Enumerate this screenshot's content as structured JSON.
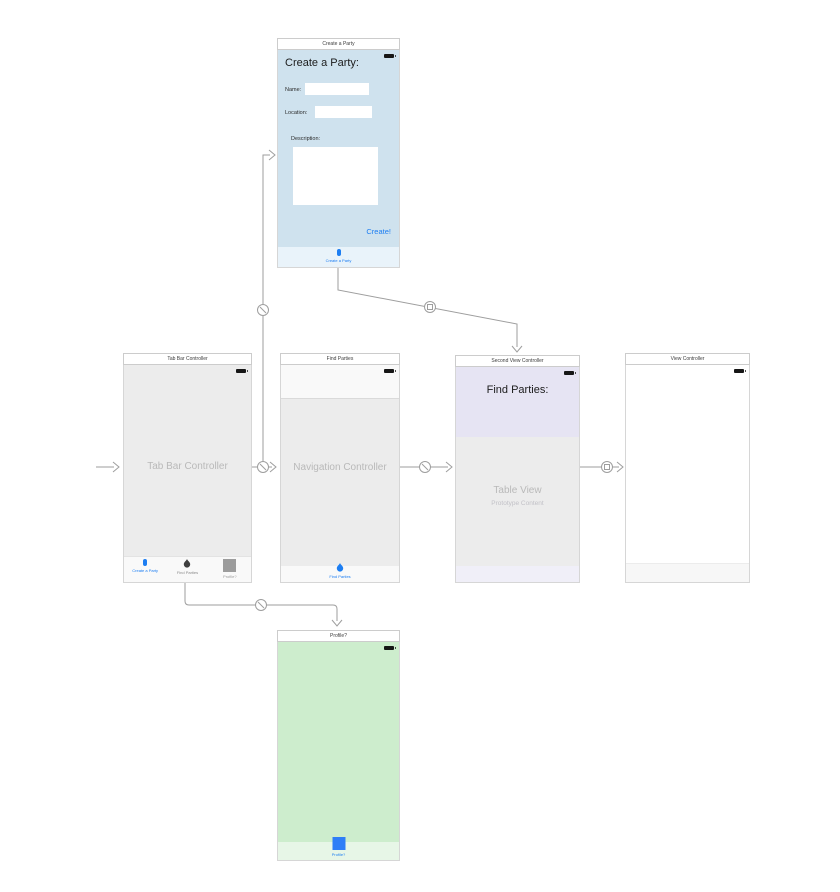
{
  "canvas": {
    "background": "#ffffff",
    "connector_color": "#9e9e9e"
  },
  "icons": {
    "battery-icon": "black rounded rectangle with nub",
    "create-party-tab-icon": "blue vertical pill",
    "find-parties-tab-icon": "flame",
    "profile-tab-icon": "gray filled square",
    "profile-scene-tab-icon": "blue filled square",
    "relationship-segue-icon": "circle with diagonal line",
    "show-segue-icon": "circle with small square"
  },
  "scenes": {
    "create_party": {
      "dock_title": "Create a Party",
      "heading": "Create a Party:",
      "name_label": "Name:",
      "name_value": "",
      "location_label": "Location:",
      "location_value": "",
      "description_label": "Description:",
      "description_value": "",
      "create_button": "Create!",
      "tab_label": "Create a Party",
      "colors": {
        "body": "#cfe2ee",
        "tab_strip": "#e9f3fa",
        "accent": "#1d7ef2"
      }
    },
    "tab_bar_controller": {
      "dock_title": "Tab Bar Controller",
      "placeholder_label": "Tab Bar Controller",
      "tabs": [
        {
          "label": "Create a Party",
          "icon": "create-party-tab-icon",
          "selected": true
        },
        {
          "label": "Find Parties",
          "icon": "find-parties-tab-icon",
          "selected": false
        },
        {
          "label": "Profile?",
          "icon": "profile-tab-icon",
          "selected": false
        }
      ],
      "colors": {
        "body": "#ececec"
      }
    },
    "navigation_controller": {
      "dock_title": "Find Parties",
      "placeholder_label": "Navigation Controller",
      "tab_label": "Find Parties",
      "colors": {
        "body": "#ececec",
        "bars": "#f9f9f9"
      }
    },
    "second_view_controller": {
      "dock_title": "Second View Controller",
      "heading": "Find Parties:",
      "table_label": "Table View",
      "table_sublabel": "Prototype Content",
      "colors": {
        "header": "#e6e4f3",
        "body": "#ececec",
        "footer": "#f0eff8"
      }
    },
    "view_controller": {
      "dock_title": "View Controller",
      "colors": {
        "body": "#ffffff",
        "footer": "#f7f7f7"
      }
    },
    "profile": {
      "dock_title": "Profile?",
      "tab_label": "Profile?",
      "colors": {
        "body": "#cdedcd",
        "tab_strip": "#e7f6e7",
        "accent": "#2e7ef7"
      }
    }
  },
  "segues": [
    {
      "from": "storyboard-entry-point",
      "to": "tab_bar_controller",
      "type": "initial-arrow"
    },
    {
      "from": "tab_bar_controller",
      "to": "create_party",
      "type": "relationship"
    },
    {
      "from": "tab_bar_controller",
      "to": "navigation_controller",
      "type": "relationship"
    },
    {
      "from": "tab_bar_controller",
      "to": "profile",
      "type": "relationship"
    },
    {
      "from": "navigation_controller",
      "to": "second_view_controller",
      "type": "relationship"
    },
    {
      "from": "create_party",
      "to": "second_view_controller",
      "type": "show"
    },
    {
      "from": "second_view_controller",
      "to": "view_controller",
      "type": "show"
    }
  ]
}
